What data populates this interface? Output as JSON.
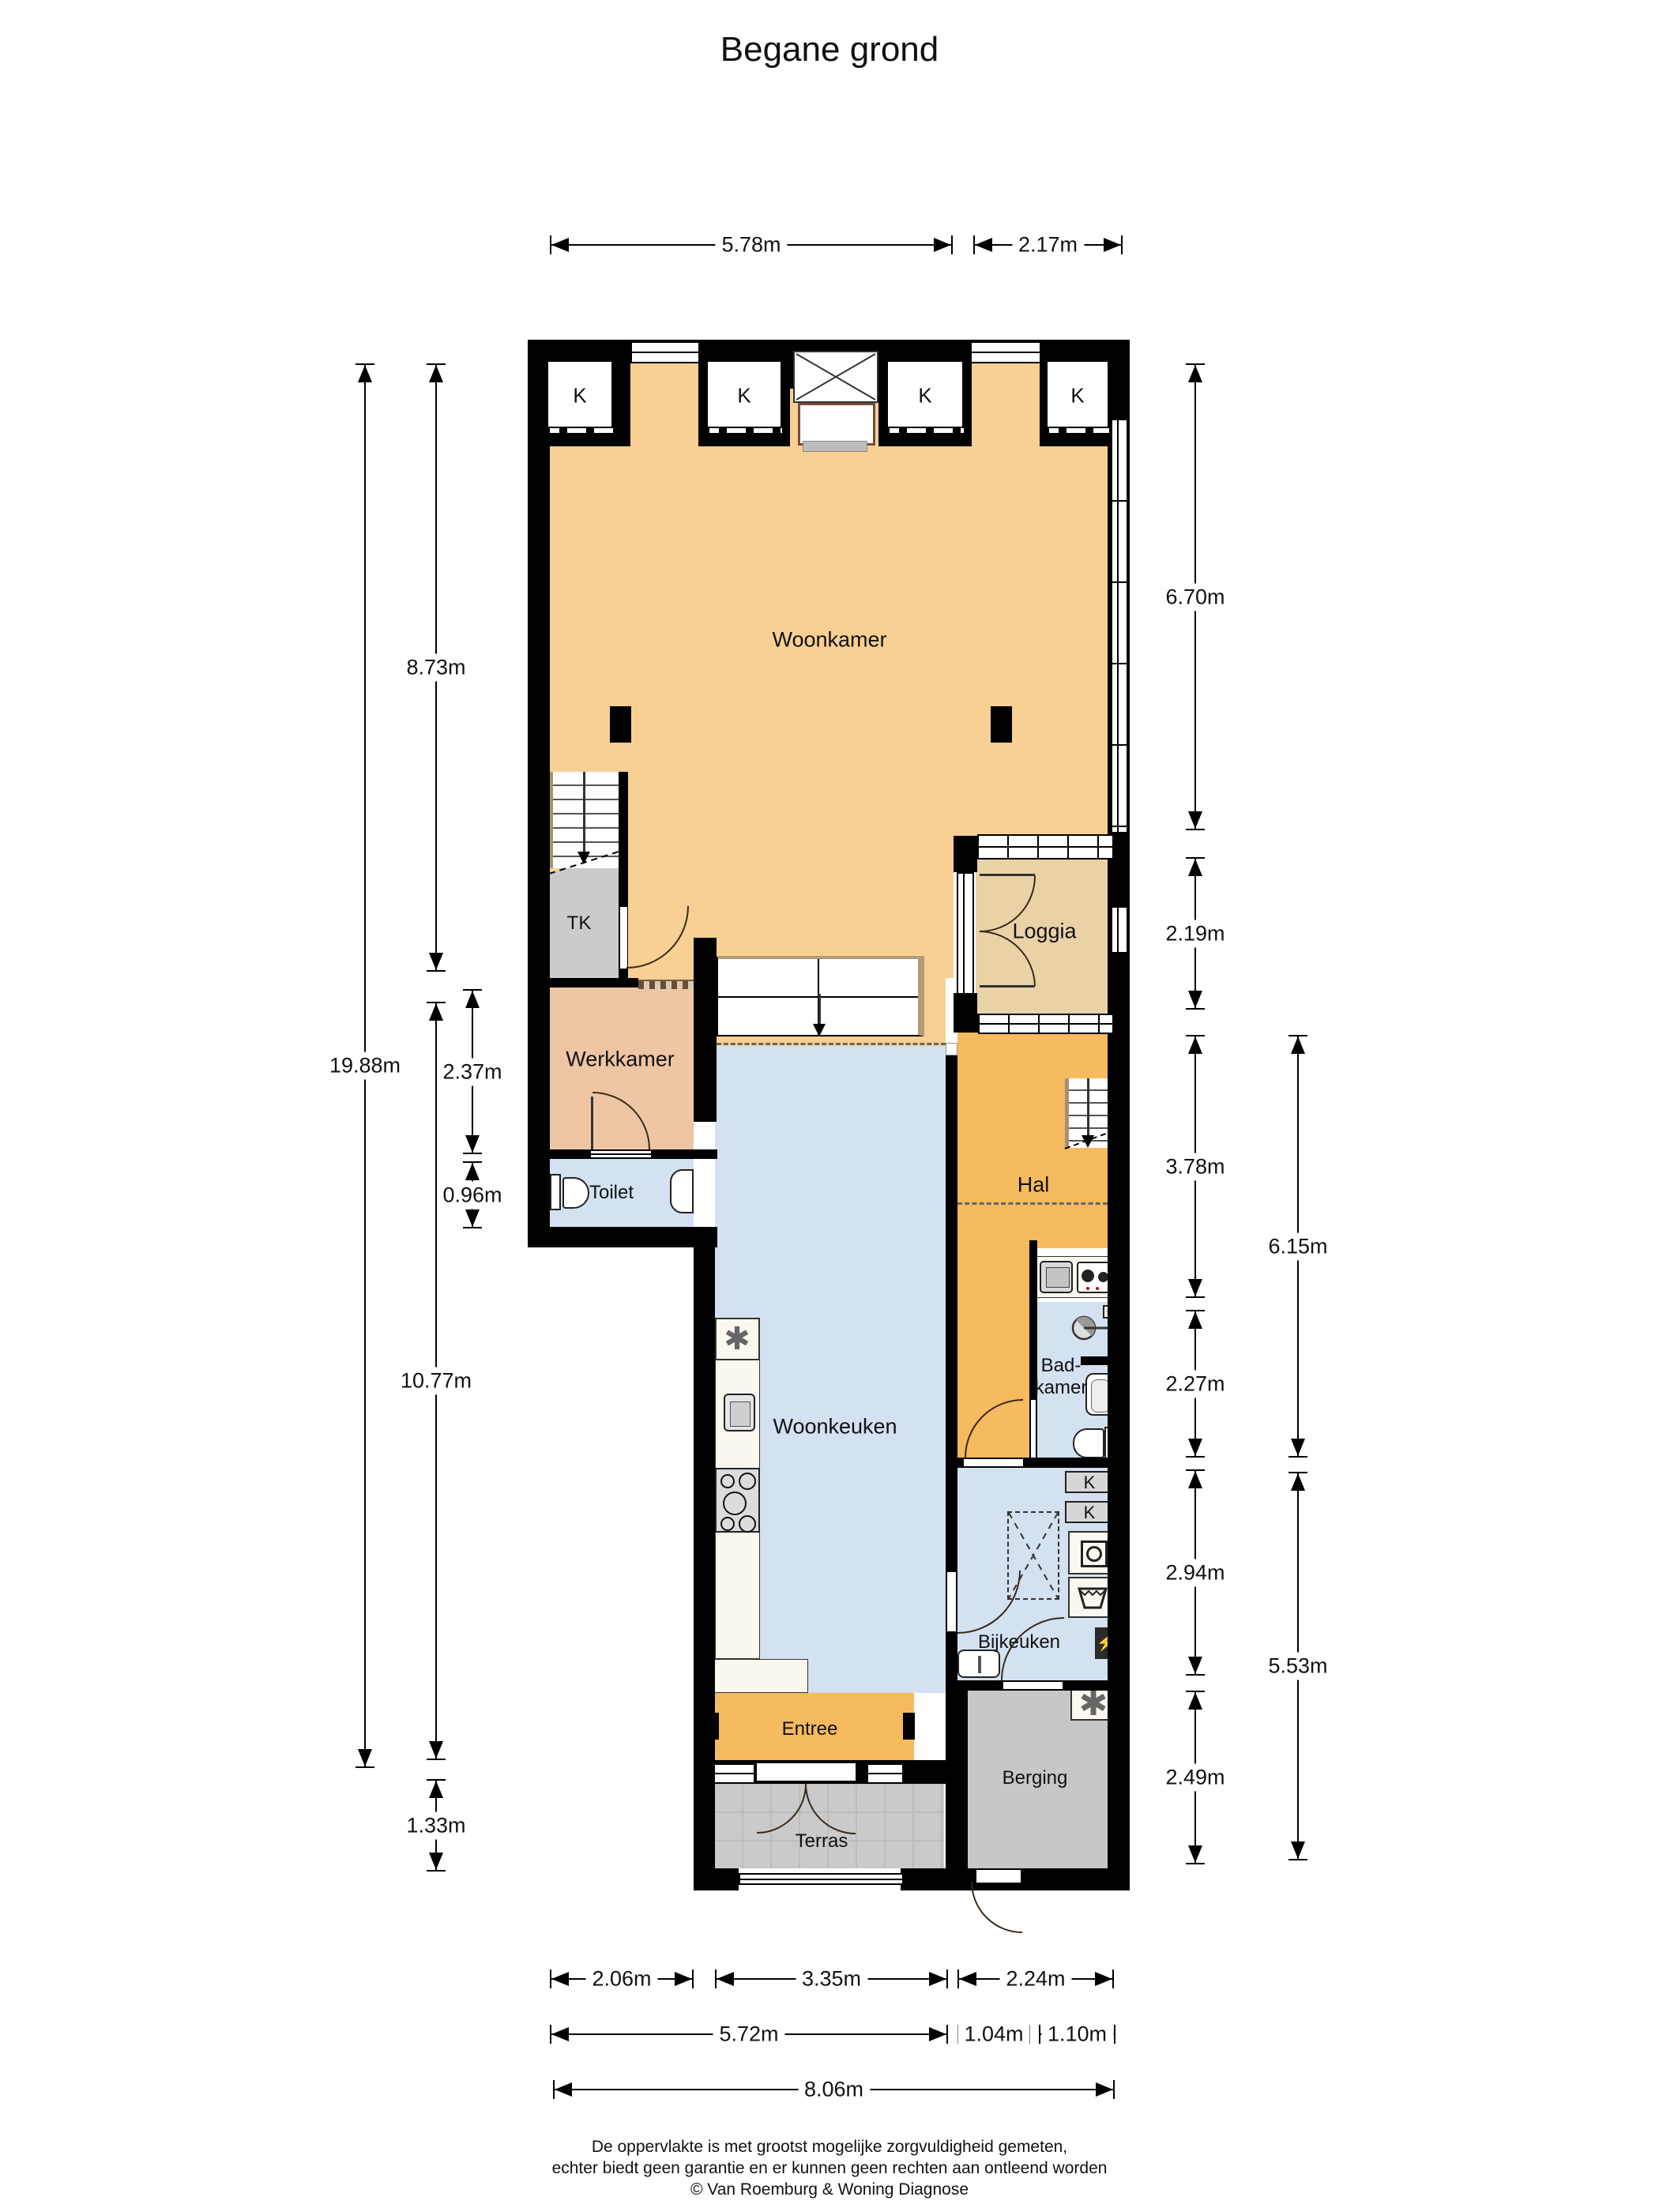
{
  "title": "Begane grond",
  "rooms": {
    "woonkamer": "Woonkamer",
    "tk": "TK",
    "loggia": "Loggia",
    "werkkamer": "Werkkamer",
    "toilet": "Toilet",
    "hal": "Hal",
    "badkamer": [
      "Bad-",
      "kamer"
    ],
    "woonkeuken": "Woonkeuken",
    "bijkeuken": "Bijkeuken",
    "entree": "Entree",
    "berging": "Berging",
    "terras": "Terras"
  },
  "closets": {
    "label": "K"
  },
  "icons": {
    "appliance_star": "✱",
    "power_bolt": "⚡"
  },
  "dimensions": {
    "top": [
      {
        "label": "5.78m"
      },
      {
        "label": "2.17m"
      }
    ],
    "left": [
      {
        "label": "8.73m"
      },
      {
        "label": "19.88m"
      },
      {
        "label": "2.37m"
      },
      {
        "label": "0.96m"
      },
      {
        "label": "10.77m"
      },
      {
        "label": "1.33m"
      }
    ],
    "right": [
      {
        "label": "6.70m"
      },
      {
        "label": "2.19m"
      },
      {
        "label": "3.78m"
      },
      {
        "label": "2.27m"
      },
      {
        "label": "2.94m"
      },
      {
        "label": "2.49m"
      },
      {
        "label": "6.15m"
      },
      {
        "label": "5.53m"
      }
    ],
    "bottom": [
      {
        "label": "2.06m"
      },
      {
        "label": "3.35m"
      },
      {
        "label": "2.24m"
      },
      {
        "label": "5.72m"
      },
      {
        "label": "1.04m"
      },
      {
        "label": "1.10m"
      },
      {
        "label": "8.06m"
      }
    ]
  },
  "footer": {
    "line1": "De oppervlakte is met grootst mogelijke zorgvuldigheid gemeten,",
    "line2": "echter biedt geen garantie en er kunnen geen rechten aan ontleend worden",
    "line3": "© Van Roemburg & Woning Diagnose"
  },
  "colors": {
    "wall": "#000000",
    "living_orange": "#f8d093",
    "hal_orange": "#f6ba5f",
    "loggia_tan": "#ead2a7",
    "werkkamer_salmon": "#eec6a3",
    "wet_blue": "#d3e1f1",
    "terras_gray": "#cacaca",
    "berging_gray": "#c7c7c9",
    "closet_gray": "#cbcbcb"
  }
}
